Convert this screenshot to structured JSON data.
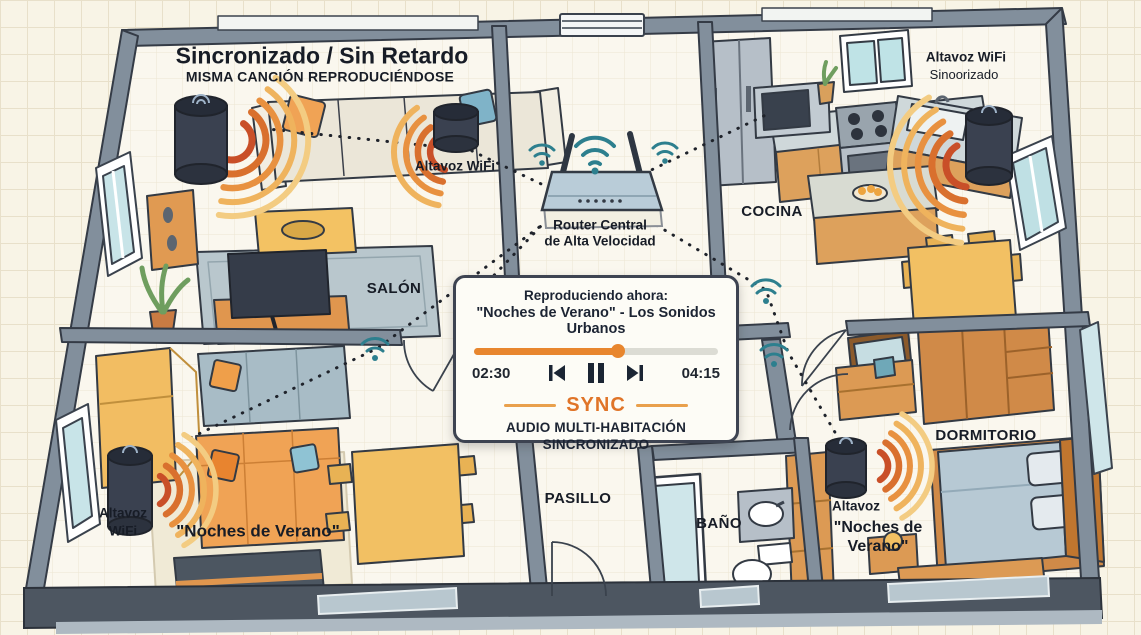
{
  "header": {
    "title": "Sincronizado / Sin Retardo",
    "subtitle": "MISMA CANCIÓN REPRODUCIÉNDOSE"
  },
  "rooms": {
    "salon": "SALÓN",
    "cocina": "COCINA",
    "pasillo": "PASILLO",
    "bano": "BAÑO",
    "dormitorio": "DORMITORIO"
  },
  "speakers": {
    "salon_label": "Altavoz WiFi",
    "kitchen_label": "Altavoz WiFi",
    "kitchen_sub": "Sinoorizado",
    "left_label_line1": "Altavoz",
    "left_label_line2": "WiFi",
    "left_song": "\"Noches de Verano\"",
    "bedroom_label": "Altavoz",
    "bedroom_song_line1": "\"Noches de",
    "bedroom_song_line2": "Verano\""
  },
  "router": {
    "line1": "Router Central",
    "line2": "de Alta Velocidad"
  },
  "player": {
    "now_playing": "Reproduciendo ahora:",
    "track": "\"Noches de Verano\" - Los Sonidos Urbanos",
    "elapsed": "02:30",
    "duration": "04:15",
    "progress_percent": 59,
    "sync": "SYNC",
    "mode_line1": "AUDIO MULTI-HABITACIÓN",
    "mode_line2": "SINCRONIZADO"
  },
  "colors": {
    "accent_orange": "#e07428",
    "wave_red": "#c94f28",
    "wifi_teal": "#2d7f8e",
    "wall_gray": "#828f9c",
    "text_navy": "#1c2433"
  }
}
